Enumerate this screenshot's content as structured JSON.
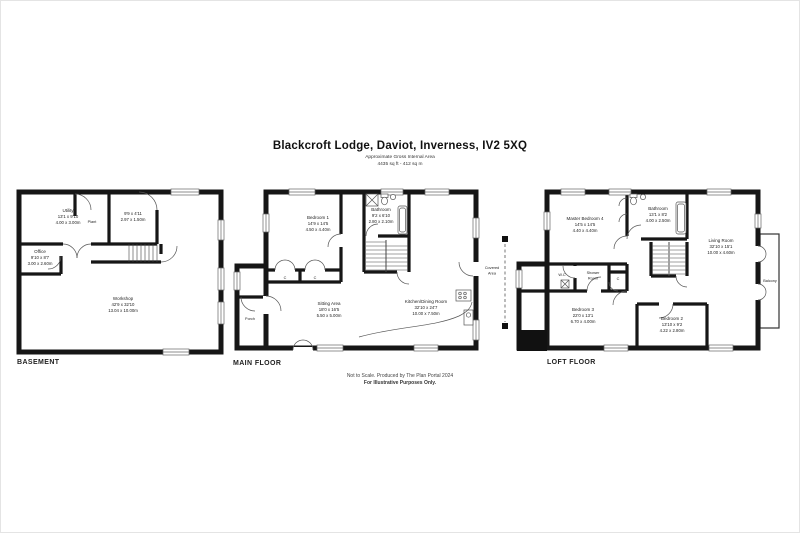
{
  "page": {
    "title": "Blackcroft Lodge, Daviot, Inverness, IV2 5XQ",
    "subtitle": "Approximate Gross Internal Area",
    "area": "4435 sq ft - 412 sq m",
    "footer_line1": "Not to Scale. Produced by The Plan Portal 2024",
    "footer_line2": "For Illustrative Purposes Only."
  },
  "floors": {
    "basement": {
      "label": "BASEMENT",
      "rooms": {
        "utility": {
          "name": "Utility",
          "imperial": "13'1 x 9'10",
          "metric": "4.00 x 3.00m"
        },
        "plant": {
          "name": "Plant"
        },
        "store": {
          "imperial": "9'9 x 4'11",
          "metric": "2.97 x 1.50m"
        },
        "office": {
          "name": "Office",
          "imperial": "9'10 x 8'7",
          "metric": "3.00 x 2.60m"
        },
        "workshop": {
          "name": "Workshop",
          "imperial": "42'9 x 32'10",
          "metric": "13.04 x 10.00m"
        }
      }
    },
    "main": {
      "label": "MAIN FLOOR",
      "rooms": {
        "bedroom1": {
          "name": "Bedroom 1",
          "imperial": "14'9 x 14'5",
          "metric": "4.50 x 4.40m"
        },
        "bathroom": {
          "name": "Bathroom",
          "imperial": "9'2 x 6'10",
          "metric": "2.80 x 2.10m"
        },
        "sitting_area": {
          "name": "Sitting Area",
          "imperial": "18'0 x 16'5",
          "metric": "5.50 x 5.00m"
        },
        "kitchen_dining": {
          "name": "Kitchen/Dining Room",
          "imperial": "32'10 x 24'7",
          "metric": "10.00 x 7.50m"
        },
        "porch": {
          "name": "Porch"
        },
        "covered_area": {
          "line1": "Covered",
          "line2": "Area"
        },
        "cupboard": {
          "name": "C"
        }
      }
    },
    "loft": {
      "label": "LOFT FLOOR",
      "rooms": {
        "master_bedroom": {
          "name": "Master Bedroom 4",
          "imperial": "14'5 x 14'5",
          "metric": "4.40 x 4.40m"
        },
        "bathroom": {
          "name": "Bathroom",
          "imperial": "13'1 x 8'2",
          "metric": "4.00 x 2.50m"
        },
        "living_room": {
          "name": "Living Room",
          "imperial": "32'10 x 15'1",
          "metric": "10.00 x 4.60m"
        },
        "balcony": {
          "name": "Balcony"
        },
        "wc": {
          "name": "W.C"
        },
        "shower_room": {
          "line1": "Shower",
          "line2": "Room"
        },
        "bedroom3": {
          "name": "Bedroom 3",
          "imperial": "22'0 x 13'1",
          "metric": "6.70 x 4.00m"
        },
        "bedroom2": {
          "name": "Bedroom 2",
          "imperial": "13'10 x 9'2",
          "metric": "4.22 x 2.80m"
        },
        "cupboard": {
          "name": "C"
        }
      }
    }
  }
}
